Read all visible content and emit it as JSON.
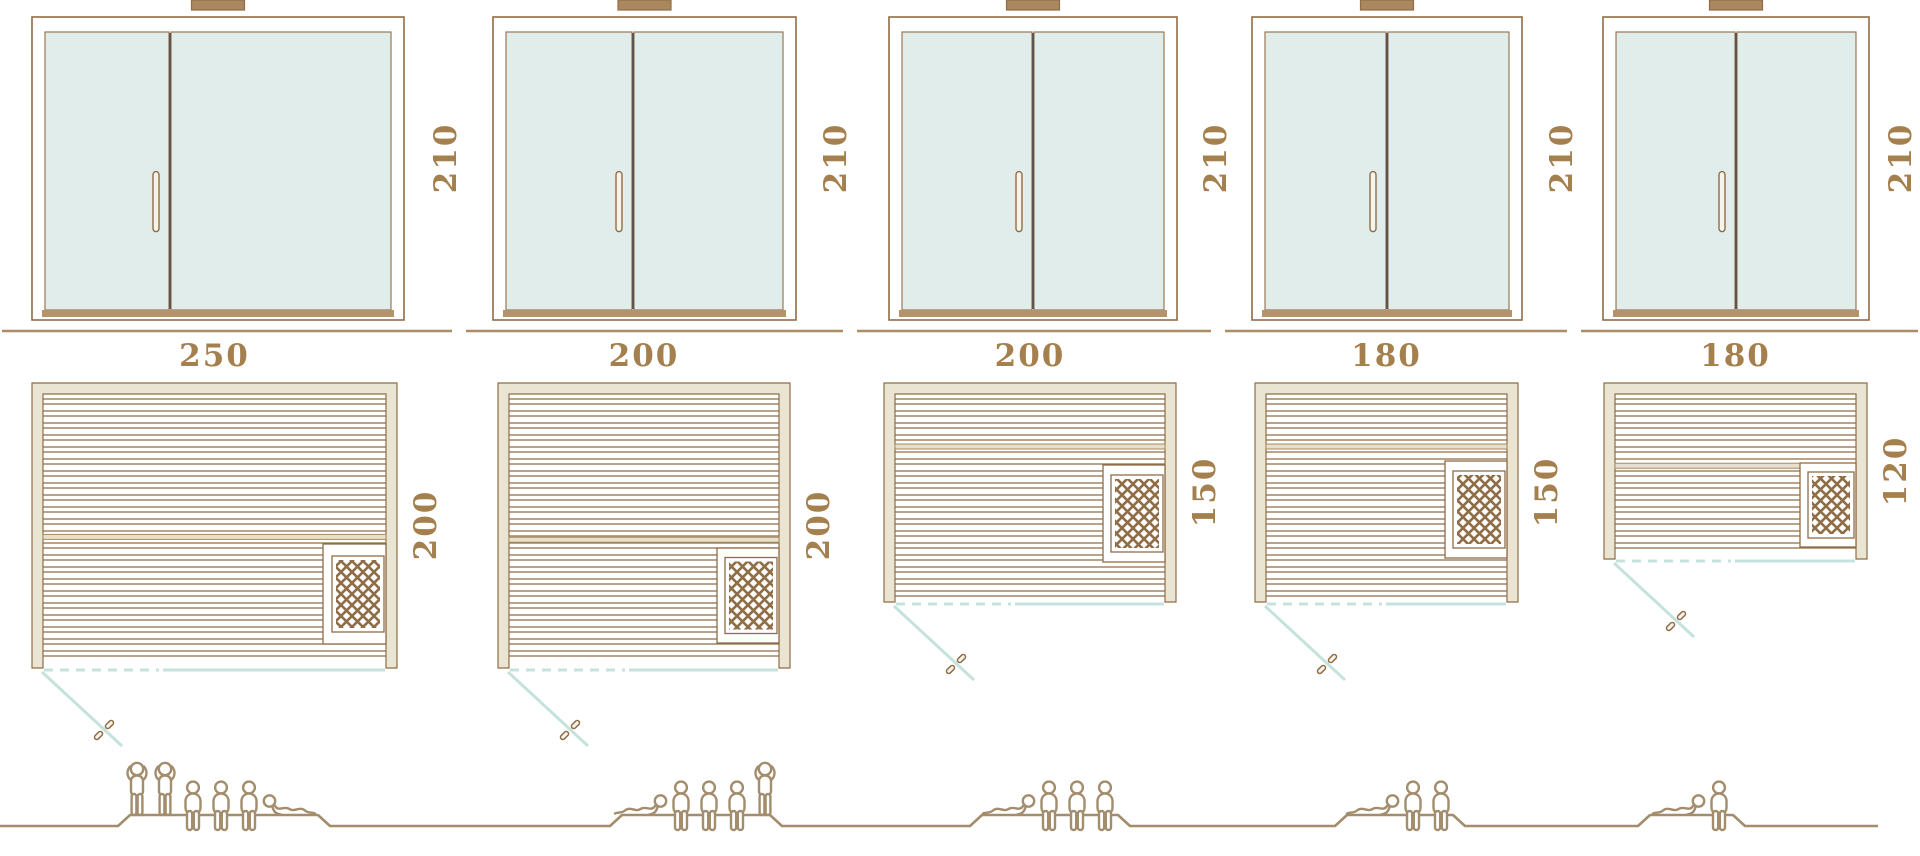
{
  "diagram": {
    "type": "sauna-size-comparison",
    "views": [
      "front-elevation",
      "floor-plan",
      "capacity-figures"
    ]
  },
  "colors": {
    "outline_brown": "#8f6d46",
    "beige_fill": "#e9e5d2",
    "glass_teal": "#e0edea",
    "teal_line": "#c5e2dd",
    "dimension_label": "#a5804f",
    "figure_tan": "#a38d6d",
    "ground_brown": "#ab8c63",
    "sill_brown": "#b3946a",
    "cap_brown": "#a98860",
    "door_divider": "#5c564e",
    "bench_band": "#e7e0ca"
  },
  "units": [
    {
      "name": "sauna-250x200",
      "front": {
        "height_label": "210"
      },
      "plan": {
        "width_label": "250",
        "depth_label": "200"
      },
      "capacity": {
        "persons": 6,
        "poses": [
          "stand",
          "stand",
          "sit",
          "sit",
          "sit",
          "recline-head-left"
        ]
      }
    },
    {
      "name": "sauna-200x200",
      "front": {
        "height_label": "210"
      },
      "plan": {
        "width_label": "200",
        "depth_label": "200"
      },
      "capacity": {
        "persons": 5,
        "poses": [
          "recline-head-right",
          "sit",
          "sit",
          "sit",
          "stand"
        ]
      }
    },
    {
      "name": "sauna-200x150",
      "front": {
        "height_label": "210"
      },
      "plan": {
        "width_label": "200",
        "depth_label": "150"
      },
      "capacity": {
        "persons": 4,
        "poses": [
          "recline-head-right",
          "sit",
          "sit",
          "sit"
        ]
      }
    },
    {
      "name": "sauna-180x150",
      "front": {
        "height_label": "210"
      },
      "plan": {
        "width_label": "180",
        "depth_label": "150"
      },
      "capacity": {
        "persons": 3,
        "poses": [
          "recline-head-right",
          "sit",
          "sit"
        ]
      }
    },
    {
      "name": "sauna-180x120",
      "front": {
        "height_label": "210"
      },
      "plan": {
        "width_label": "180",
        "depth_label": "120"
      },
      "capacity": {
        "persons": 2,
        "poses": [
          "recline-head-right",
          "sit"
        ]
      }
    }
  ]
}
